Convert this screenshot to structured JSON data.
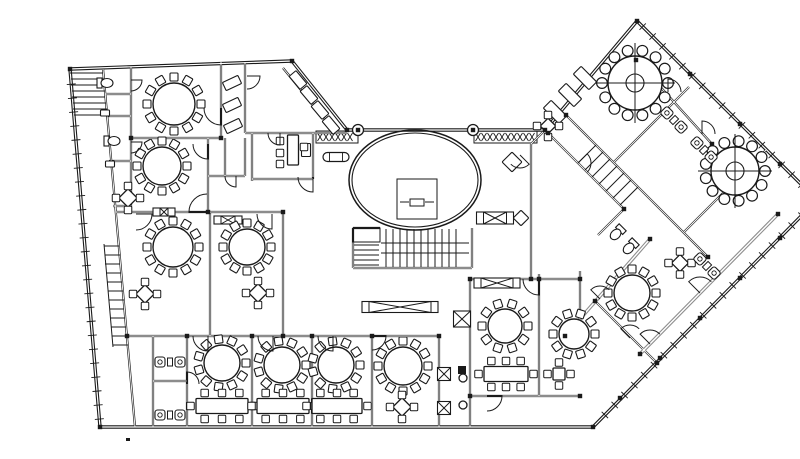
{
  "meta": {
    "width": 800,
    "height": 427,
    "kind": "architectural-floor-plan"
  },
  "colors": {
    "ink": "#1a1a1a",
    "gray": "#8d8d8d",
    "paper": "#ffffff"
  },
  "plan": {
    "walls": [
      [
        30,
        53,
        252,
        45,
        0
      ],
      [
        252,
        45,
        307,
        114,
        0
      ],
      [
        307,
        114,
        505,
        114,
        0
      ],
      [
        505,
        114,
        597,
        5,
        0
      ],
      [
        597,
        5,
        777,
        184,
        0
      ],
      [
        777,
        184,
        553,
        411,
        0
      ],
      [
        553,
        411,
        60,
        411,
        0
      ],
      [
        60,
        411,
        30,
        53,
        0
      ],
      [
        63,
        53,
        95,
        411,
        1
      ],
      [
        91,
        51,
        91,
        196,
        1
      ],
      [
        65,
        78,
        91,
        78,
        1
      ],
      [
        66,
        100,
        91,
        100,
        1
      ],
      [
        69,
        145,
        91,
        145,
        1
      ],
      [
        73,
        190,
        91,
        190,
        1
      ],
      [
        181,
        46,
        181,
        122,
        1
      ],
      [
        91,
        122,
        181,
        122,
        1
      ],
      [
        168,
        122,
        168,
        196,
        1
      ],
      [
        76,
        196,
        243,
        196,
        1
      ],
      [
        205,
        46,
        205,
        117,
        1
      ],
      [
        243,
        52,
        296,
        117,
        1
      ],
      [
        205,
        117,
        307,
        117,
        1
      ],
      [
        212,
        117,
        212,
        165,
        1
      ],
      [
        273,
        117,
        273,
        163,
        1
      ],
      [
        212,
        163,
        273,
        163,
        1
      ],
      [
        185,
        122,
        185,
        160,
        1
      ],
      [
        205,
        122,
        205,
        160,
        1
      ],
      [
        168,
        160,
        205,
        160,
        1
      ],
      [
        170,
        196,
        170,
        320,
        1
      ],
      [
        243,
        196,
        243,
        320,
        1
      ],
      [
        87,
        320,
        399,
        320,
        1
      ],
      [
        113,
        320,
        113,
        411,
        1
      ],
      [
        147,
        320,
        147,
        411,
        1
      ],
      [
        212,
        320,
        212,
        411,
        1
      ],
      [
        272,
        320,
        272,
        411,
        1
      ],
      [
        332,
        320,
        332,
        411,
        1
      ],
      [
        399,
        320,
        399,
        411,
        1
      ],
      [
        430,
        263,
        430,
        411,
        1
      ],
      [
        113,
        365,
        147,
        365,
        1
      ],
      [
        313,
        212,
        313,
        252,
        1
      ],
      [
        313,
        252,
        432,
        252,
        1
      ],
      [
        432,
        212,
        432,
        252,
        1
      ],
      [
        313,
        212,
        340,
        212,
        1
      ],
      [
        430,
        263,
        540,
        263,
        1
      ],
      [
        499,
        258,
        499,
        380,
        1
      ],
      [
        430,
        380,
        540,
        380,
        1
      ],
      [
        540,
        255,
        540,
        300,
        1
      ],
      [
        505,
        114,
        491,
        128,
        1
      ],
      [
        491,
        128,
        491,
        263,
        1
      ],
      [
        508,
        117,
        584,
        193,
        1
      ],
      [
        526,
        99,
        668,
        241,
        1
      ],
      [
        649,
        71,
        574,
        146,
        1
      ],
      [
        555,
        285,
        617,
        347,
        1
      ],
      [
        584,
        193,
        558,
        219,
        1
      ],
      [
        726,
        134,
        644,
        216,
        1
      ],
      [
        596,
        44,
        672,
        128,
        1
      ],
      [
        525,
        320,
        610,
        223,
        2
      ],
      [
        738,
        198,
        600,
        338,
        2
      ]
    ],
    "tickedWalls": [
      4,
      5,
      7
    ],
    "doors": [
      [
        181,
        92,
        17,
        90,
        180
      ],
      [
        168,
        128,
        15,
        90,
        180
      ],
      [
        91,
        64,
        11,
        0,
        90
      ],
      [
        91,
        126,
        11,
        0,
        90
      ],
      [
        96,
        198,
        16,
        0,
        90
      ],
      [
        167,
        196,
        18,
        180,
        270
      ],
      [
        232,
        198,
        15,
        90,
        180
      ],
      [
        273,
        161,
        15,
        90,
        180
      ],
      [
        207,
        60,
        13,
        0,
        90
      ],
      [
        240,
        117,
        12,
        90,
        180
      ],
      [
        196,
        160,
        11,
        90,
        180
      ],
      [
        168,
        320,
        15,
        90,
        180
      ],
      [
        233,
        320,
        15,
        90,
        180
      ],
      [
        293,
        320,
        15,
        90,
        180
      ],
      [
        332,
        320,
        14,
        0,
        90
      ],
      [
        147,
        368,
        12,
        270,
        360
      ],
      [
        499,
        263,
        16,
        90,
        180
      ],
      [
        447,
        380,
        15,
        0,
        90
      ],
      [
        628,
        76,
        13,
        270,
        360
      ],
      [
        662,
        118,
        13,
        270,
        360
      ],
      [
        538,
        147,
        13,
        315,
        405
      ],
      [
        560,
        283,
        13,
        225,
        315
      ],
      [
        590,
        322,
        13,
        225,
        315
      ],
      [
        660,
        277,
        16,
        225,
        315
      ],
      [
        610,
        328,
        14,
        225,
        315
      ],
      [
        480,
        139,
        13,
        45,
        135
      ]
    ],
    "roundTables": [
      [
        134,
        88,
        21,
        12,
        0
      ],
      [
        122,
        150,
        19,
        12,
        0
      ],
      [
        133,
        231,
        20,
        12,
        0
      ],
      [
        207,
        231,
        18,
        12,
        0
      ],
      [
        182,
        347,
        18,
        11,
        0
      ],
      [
        242,
        349,
        18,
        11,
        0
      ],
      [
        296,
        349,
        18,
        11,
        0
      ],
      [
        363,
        350,
        19,
        12,
        0
      ],
      [
        465,
        310,
        17,
        10,
        0
      ],
      [
        534,
        318,
        15,
        10,
        0
      ],
      [
        592,
        277,
        18,
        12,
        0
      ],
      [
        595,
        67,
        27,
        14,
        1
      ],
      [
        695,
        155,
        24,
        13,
        1
      ]
    ],
    "squareTables": [
      [
        88,
        182,
        13,
        45
      ],
      [
        105,
        278,
        13,
        45
      ],
      [
        218,
        277,
        13,
        45
      ],
      [
        362,
        391,
        13,
        45
      ],
      [
        519,
        358,
        12,
        0
      ],
      [
        640,
        247,
        12,
        45
      ],
      [
        508,
        110,
        11,
        45
      ]
    ],
    "rectTables": [
      [
        182,
        390,
        52,
        15
      ],
      [
        243,
        390,
        52,
        15
      ],
      [
        297,
        390,
        50,
        15
      ],
      [
        466,
        358,
        44,
        15
      ]
    ],
    "desks": [
      [
        253,
        134,
        11,
        30
      ]
    ],
    "chairs": [
      [
        240,
        125
      ],
      [
        240,
        137
      ],
      [
        240,
        148
      ],
      [
        264,
        131
      ]
    ],
    "ovalTables": [
      [
        296,
        141,
        26,
        9
      ]
    ],
    "lounges": [
      [
        130,
        346,
        0
      ],
      [
        130,
        399,
        0
      ],
      [
        634,
        104,
        45
      ],
      [
        664,
        134,
        45
      ],
      [
        667,
        250,
        45
      ]
    ],
    "wcs": [
      [
        65,
        67,
        0
      ],
      [
        72,
        125,
        0
      ],
      [
        577,
        217,
        135
      ],
      [
        590,
        231,
        135
      ]
    ],
    "counters": [
      [
        258,
        64,
        17,
        9,
        50
      ],
      [
        269,
        79,
        17,
        9,
        50
      ],
      [
        280,
        94,
        17,
        9,
        50
      ],
      [
        291,
        109,
        17,
        9,
        50
      ],
      [
        192,
        67,
        17,
        9,
        -25
      ],
      [
        192,
        89,
        17,
        9,
        -25
      ],
      [
        193,
        110,
        17,
        9,
        -25
      ],
      [
        545,
        62,
        22,
        11,
        45
      ],
      [
        530,
        79,
        22,
        11,
        45
      ],
      [
        515,
        96,
        22,
        11,
        45
      ],
      [
        266,
        134,
        9,
        13,
        0
      ],
      [
        472,
        146,
        14,
        14,
        45
      ],
      [
        481,
        202,
        11,
        11,
        45
      ],
      [
        65,
        97,
        9,
        6,
        0
      ],
      [
        70,
        148,
        9,
        6,
        0
      ]
    ],
    "xLong": [
      [
        360,
        291,
        76,
        11
      ],
      [
        455,
        202,
        37,
        12
      ],
      [
        457,
        267,
        46,
        10
      ],
      [
        124,
        196,
        22,
        8
      ],
      [
        188,
        204,
        28,
        8
      ]
    ],
    "xBox": [
      [
        422,
        303,
        17,
        16
      ],
      [
        404,
        358,
        13,
        13
      ],
      [
        404,
        392,
        13,
        13
      ]
    ],
    "hatchBands": [
      [
        276,
        115,
        42,
        12
      ],
      [
        434,
        115,
        63,
        12
      ]
    ],
    "columns": [
      [
        318,
        114,
        5.5
      ],
      [
        433,
        114,
        5.5
      ],
      [
        423,
        362,
        4
      ],
      [
        423,
        389,
        4
      ]
    ],
    "nodes": [
      [
        30,
        53
      ],
      [
        252,
        45
      ],
      [
        307,
        114
      ],
      [
        505,
        114
      ],
      [
        597,
        5
      ],
      [
        777,
        184
      ],
      [
        553,
        411
      ],
      [
        60,
        411
      ],
      [
        318,
        114
      ],
      [
        433,
        114
      ],
      [
        181,
        122
      ],
      [
        91,
        122
      ],
      [
        168,
        196
      ],
      [
        243,
        196
      ],
      [
        243,
        320
      ],
      [
        87,
        320
      ],
      [
        147,
        320
      ],
      [
        212,
        320
      ],
      [
        272,
        320
      ],
      [
        332,
        320
      ],
      [
        399,
        320
      ],
      [
        430,
        263
      ],
      [
        499,
        263
      ],
      [
        540,
        263
      ],
      [
        430,
        380
      ],
      [
        540,
        380
      ],
      [
        650,
        58
      ],
      [
        700,
        108
      ],
      [
        740,
        148
      ],
      [
        740,
        222
      ],
      [
        700,
        262
      ],
      [
        660,
        302
      ],
      [
        620,
        342
      ],
      [
        580,
        382
      ],
      [
        596,
        44
      ],
      [
        672,
        128
      ],
      [
        526,
        99
      ],
      [
        668,
        241
      ],
      [
        508,
        117
      ],
      [
        584,
        193
      ],
      [
        738,
        198
      ],
      [
        600,
        338
      ],
      [
        525,
        320
      ],
      [
        610,
        223
      ],
      [
        555,
        285
      ],
      [
        617,
        347
      ],
      [
        491,
        263
      ]
    ],
    "solids": [
      [
        418,
        350,
        8,
        8
      ],
      [
        86,
        422,
        4,
        3
      ]
    ],
    "oval": {
      "cx": 375,
      "cy": 164,
      "rx": 66,
      "ry": 50
    },
    "thinRects": [
      [
        357,
        163,
        40,
        40
      ],
      [
        370,
        183,
        14,
        7
      ],
      [
        313,
        212,
        27,
        14
      ]
    ],
    "extraSegs": [
      [
        30,
        57,
        63,
        57
      ],
      [
        31,
        63,
        64,
        63
      ],
      [
        31,
        69,
        64,
        69
      ],
      [
        32,
        75,
        65,
        75
      ],
      [
        32,
        81,
        65,
        81
      ],
      [
        33,
        87,
        66,
        87
      ],
      [
        33,
        93,
        67,
        93
      ],
      [
        34,
        99,
        67,
        99
      ],
      [
        64,
        230,
        79,
        230
      ],
      [
        65,
        239,
        80,
        239
      ],
      [
        65,
        248,
        80,
        248
      ],
      [
        66,
        257,
        81,
        257
      ],
      [
        67,
        266,
        82,
        266
      ],
      [
        68,
        275,
        83,
        275
      ],
      [
        69,
        284,
        84,
        284
      ],
      [
        70,
        293,
        84,
        293
      ],
      [
        70,
        302,
        85,
        302
      ],
      [
        71,
        311,
        86,
        311
      ],
      [
        72,
        320,
        87,
        320
      ],
      [
        73,
        329,
        88,
        329
      ],
      [
        64,
        228,
        73,
        331
      ],
      [
        346,
        213,
        346,
        251
      ],
      [
        353,
        213,
        353,
        251
      ],
      [
        360,
        213,
        360,
        251
      ],
      [
        367,
        213,
        367,
        251
      ],
      [
        374,
        213,
        374,
        251
      ],
      [
        381,
        213,
        381,
        251
      ],
      [
        388,
        213,
        388,
        251
      ],
      [
        395,
        213,
        395,
        251
      ],
      [
        402,
        213,
        402,
        251
      ],
      [
        409,
        213,
        409,
        251
      ],
      [
        416,
        213,
        416,
        251
      ],
      [
        341,
        227,
        429,
        227
      ],
      [
        341,
        237,
        429,
        237
      ],
      [
        314,
        229,
        339,
        229
      ],
      [
        314,
        234,
        339,
        234
      ],
      [
        314,
        239,
        339,
        239
      ],
      [
        314,
        244,
        339,
        244
      ],
      [
        314,
        249,
        339,
        249
      ],
      [
        538,
        147,
        556,
        129
      ],
      [
        545,
        154,
        563,
        136
      ],
      [
        552,
        161,
        570,
        143
      ],
      [
        559,
        168,
        577,
        150
      ],
      [
        566,
        175,
        584,
        157
      ],
      [
        573,
        182,
        591,
        164
      ],
      [
        580,
        189,
        598,
        171
      ],
      [
        360,
        186,
        369,
        186
      ],
      [
        385,
        186,
        394,
        186
      ]
    ]
  }
}
